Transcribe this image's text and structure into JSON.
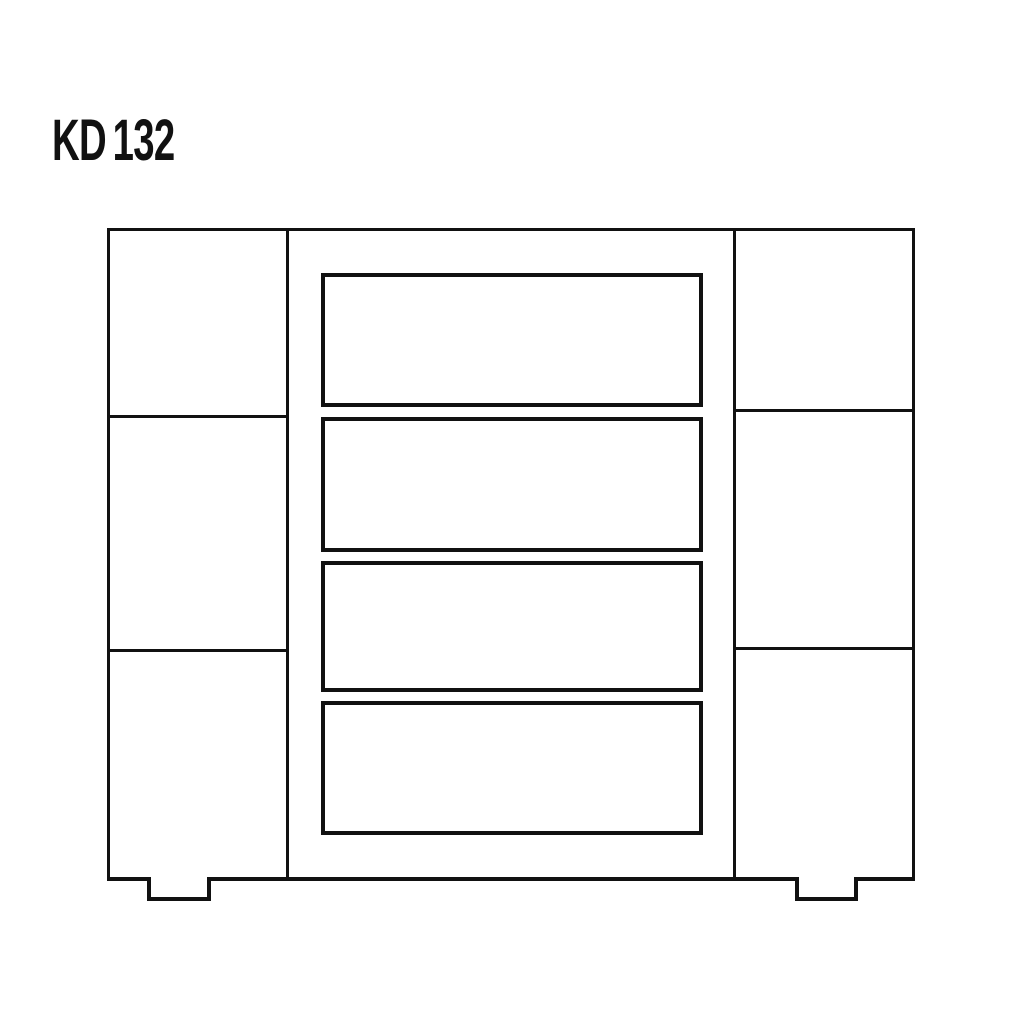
{
  "page": {
    "background": "#ffffff",
    "line_color": "#111111"
  },
  "label": {
    "prefix": "KD",
    "number": "132",
    "text": "KD132"
  },
  "diagram": {
    "kind": "cabinet-front-elevation-line-drawing",
    "model": "KD132",
    "center_drawer_count": 4,
    "left_panel_count": 3,
    "right_panel_count": 3,
    "feet_count": 2
  }
}
